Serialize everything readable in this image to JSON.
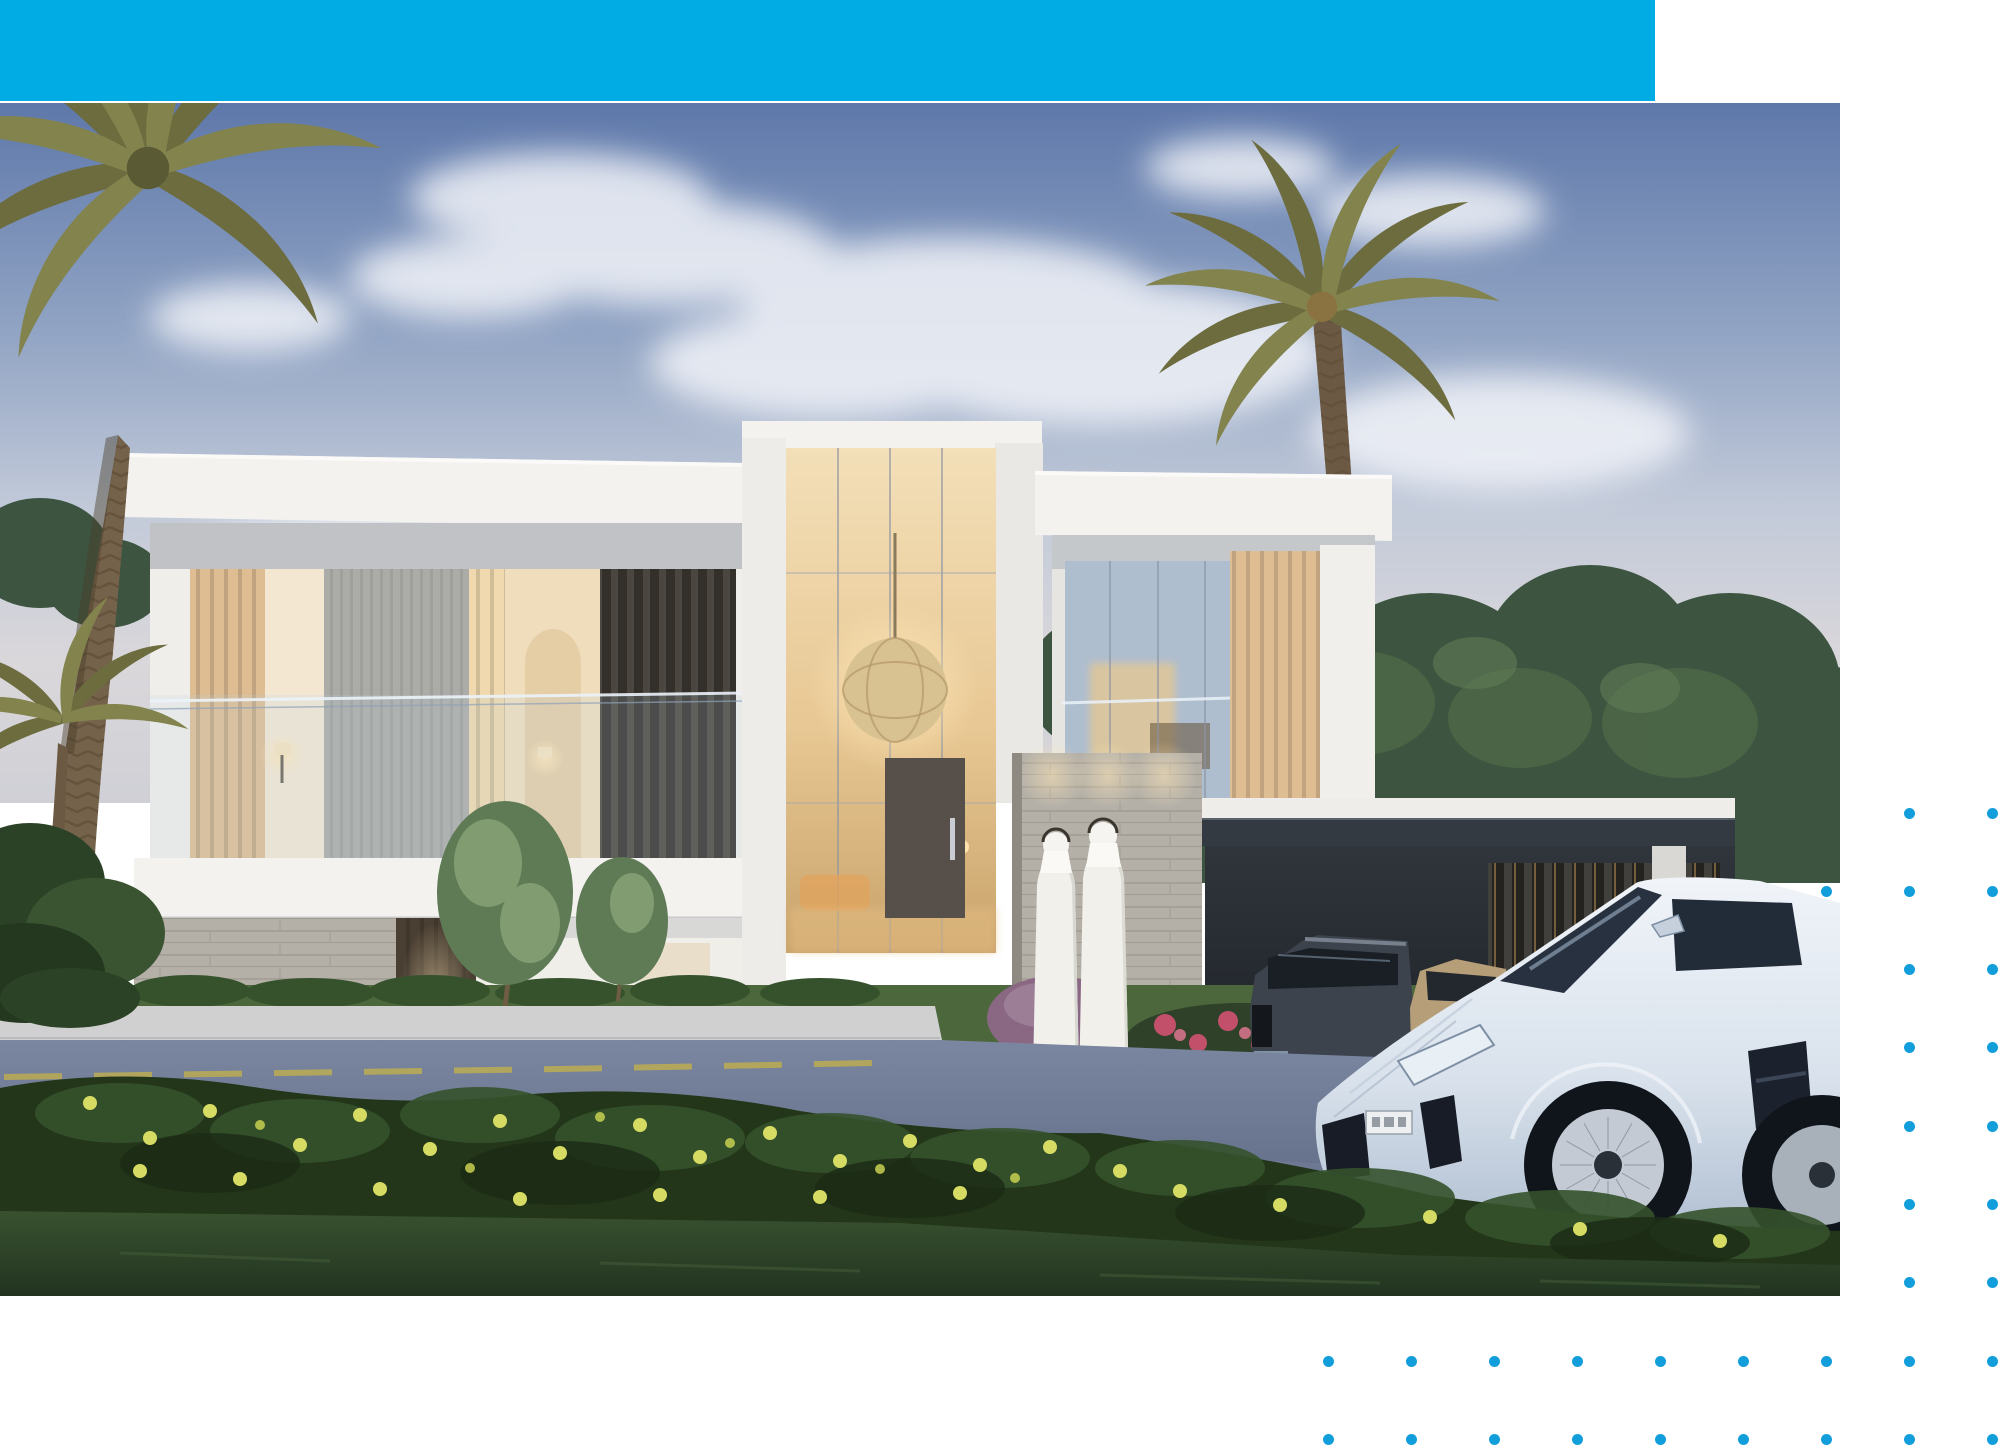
{
  "page": {
    "width": 2000,
    "height": 1445
  },
  "colors": {
    "page_bg": "#FFFFFF",
    "accent_bar": "#00ACE3",
    "dot": "#129EDB",
    "sky_top": "#5E78AA",
    "sky_mid": "#90A3C3",
    "sky_low": "#C2CAD9",
    "sky_horizon": "#DAD7DA",
    "cloud": "#F1F3F8",
    "tree_dark": "#3C5440",
    "tree_mid": "#4E6847",
    "tree_light": "#5F7B55",
    "palm_frond": "#83834E",
    "palm_frond_dark": "#6C6C3F",
    "palm_trunk": "#75624A",
    "villa_white": "#F3F2EF",
    "villa_shade": "#E6E5E1",
    "soffit": "#C9CBCF",
    "wood_slat": "#DFBD93",
    "wood_lit": "#F0D9AE",
    "stone_flute": "#ABABA7",
    "travertine": "#B4B0A8",
    "louver_dark": "#4B463F",
    "glass_cool": "#AEBECF",
    "glass_warm_top": "#F3DFB8",
    "glass_warm_low": "#C9A36B",
    "interior_glow": "#E8C88F",
    "carport_roof": "#343A42",
    "carport_shadow": "#23272D",
    "suv_body": "#3C434C",
    "sedan_body": "#B59E78",
    "lambo_body_hi": "#F0F4F9",
    "lambo_body_low": "#AEBDD0",
    "lambo_glass": "#28313F",
    "robe_white": "#F1F0EB",
    "walkway": "#CBC8C2",
    "sidewalk": "#D0D0D1",
    "road_top": "#7B87A1",
    "road_bottom": "#57627C",
    "road_line_yellow": "#C6B248",
    "lawn": "#4C673C",
    "shrub_dark": "#233619",
    "shrub_mid": "#35522C",
    "flower_yellow": "#D6DC63",
    "flower_red": "#C2506B",
    "bush_purple": "#8A6884",
    "grass_top": "#39512F",
    "grass_bottom": "#223420",
    "sphere_lamp": "#D9C291",
    "door_wood": "#57504A"
  },
  "dot_grid": {
    "origin_x": 1328,
    "origin_y": 813,
    "cols": 9,
    "rows": 9,
    "dx": 83.1,
    "dy": 78.3,
    "radius": 5.5
  },
  "photo": {
    "description": "Dusk architectural rendering of a modern two-storey luxury villa with warm lit interiors and wood-slat screens, palm trees, two men in white kanduras walking toward the entrance, a dark SUV and a gold car parked under the carport, and a pale blue Lamborghini parked on the road in front, with flowering shrubs and lawn in the foreground."
  }
}
